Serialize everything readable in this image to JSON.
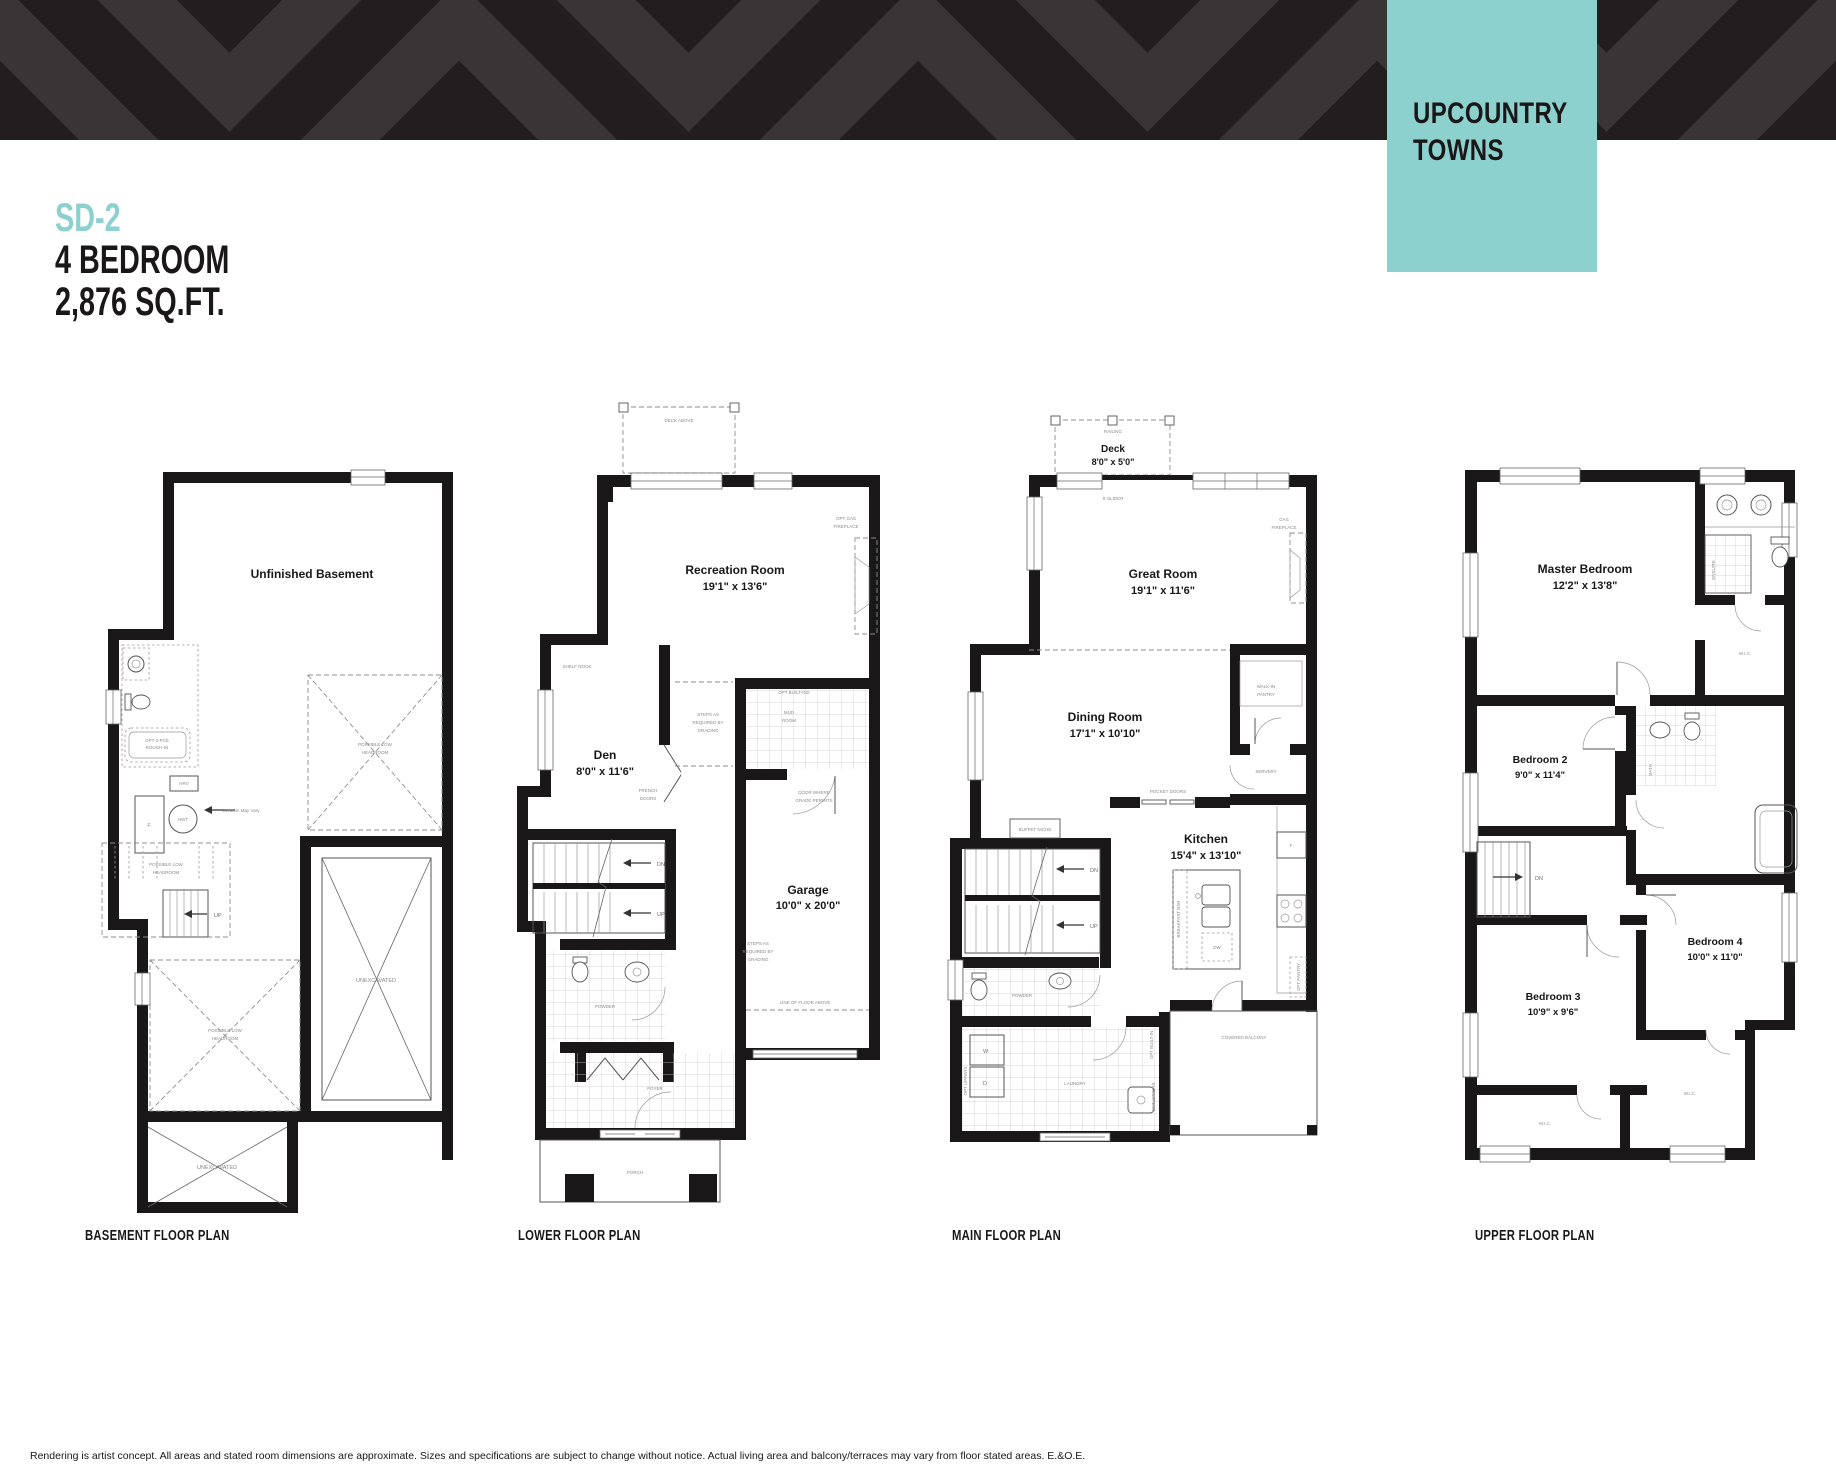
{
  "header": {
    "plan_code": "SD-2",
    "subtitle1": "4 BEDROOM",
    "subtitle2": "2,876 SQ.FT.",
    "brand_line1": "UPCOUNTRY",
    "brand_line2": "TOWNS",
    "accent_color": "#8CD1CD",
    "band_black": "#221E1F",
    "band_gray": "#393536"
  },
  "common": {
    "dn": "DN",
    "up": "UP",
    "wic": "W.I.C.",
    "powder": "POWDER"
  },
  "plans": {
    "basement": {
      "title": "BASEMENT FLOOR PLAN",
      "labels": {
        "room": "Unfinished Basement",
        "rough_in_1": "OPT 3-PCE",
        "rough_in_2": "ROUGH-IN",
        "hrv": "HRV",
        "furnace": "F",
        "hwt": "HWT",
        "location": "Location May Vary",
        "plh_1": "POSSIBLE LOW",
        "plh_2": "HEADROOM",
        "unexcavated": "UNEXCAVATED"
      }
    },
    "lower": {
      "title": "LOWER FLOOR PLAN",
      "labels": {
        "deck_above": "DECK ABOVE",
        "rec_room": "Recreation Room",
        "rec_dims": "19'1\" x 13'6\"",
        "opt_gas_1": "OPT GAS",
        "opt_gas_2": "FIREPLACE",
        "shelf_nook": "SHELF NOOK",
        "den": "Den",
        "den_dims": "8'0\" x 11'6\"",
        "steps_1": "STEPS AS",
        "steps_2": "REQUIRED BY",
        "steps_3": "GRADING",
        "mud_1": "MUD",
        "mud_2": "ROOM",
        "opt_builtins": "OPT BUILT-INS",
        "door_grade_1": "DOOR WHERE",
        "door_grade_2": "GRADE PERMITS",
        "garage": "Garage",
        "garage_dims": "10'0\" x 20'0\"",
        "french_1": "FRENCH",
        "french_2": "DOORS",
        "line_above": "LINE OF FLOOR ABOVE",
        "foyer": "FOYER",
        "porch": "PORCH"
      }
    },
    "main": {
      "title": "MAIN FLOOR PLAN",
      "labels": {
        "railing": "RAILING",
        "deck": "Deck",
        "deck_dims": "8'0\" x 5'0\"",
        "slider": "6' SLIDER",
        "great": "Great Room",
        "great_dims": "19'1\" x 11'6\"",
        "gas_1": "GAS",
        "gas_2": "FIREPLACE",
        "wip_1": "WALK-IN",
        "wip_2": "PANTRY",
        "servery": "SERVERY",
        "pocket": "POCKET DOORS",
        "dining": "Dining Room",
        "dining_dims": "17'1\" x 10'10\"",
        "kitchen": "Kitchen",
        "kitchen_dims": "15'4\" x 13'10\"",
        "buffet": "BUFFET NICHE",
        "breakfast": "BREAKFAST BAR",
        "dw": "DW",
        "fridge": "F",
        "opt_pantry": "OPT PANTRY",
        "covered_balcony": "COVERED BALCONY",
        "laundry": "LAUNDRY",
        "washer": "W",
        "dryer": "D",
        "opt_uppers": "OPT UPPERS",
        "opt_builtin": "OPT BUILT-IN"
      }
    },
    "upper": {
      "title": "UPPER FLOOR PLAN",
      "labels": {
        "master": "Master Bedroom",
        "master_dims": "12'2\" x 13'8\"",
        "ensuite": "ENSUITE",
        "bath": "BATH",
        "bed2": "Bedroom 2",
        "bed2_dims": "9'0\" x 11'4\"",
        "bed3": "Bedroom 3",
        "bed3_dims": "10'9\" x 9'6\"",
        "bed4": "Bedroom 4",
        "bed4_dims": "10'0\" x 11'0\""
      }
    }
  },
  "footer": {
    "disclaimer": "Rendering is artist concept. All areas and stated room dimensions are approximate. Sizes and specifications are subject to change without notice. Actual living area and balcony/terraces may vary from floor stated areas. E.&O.E."
  }
}
